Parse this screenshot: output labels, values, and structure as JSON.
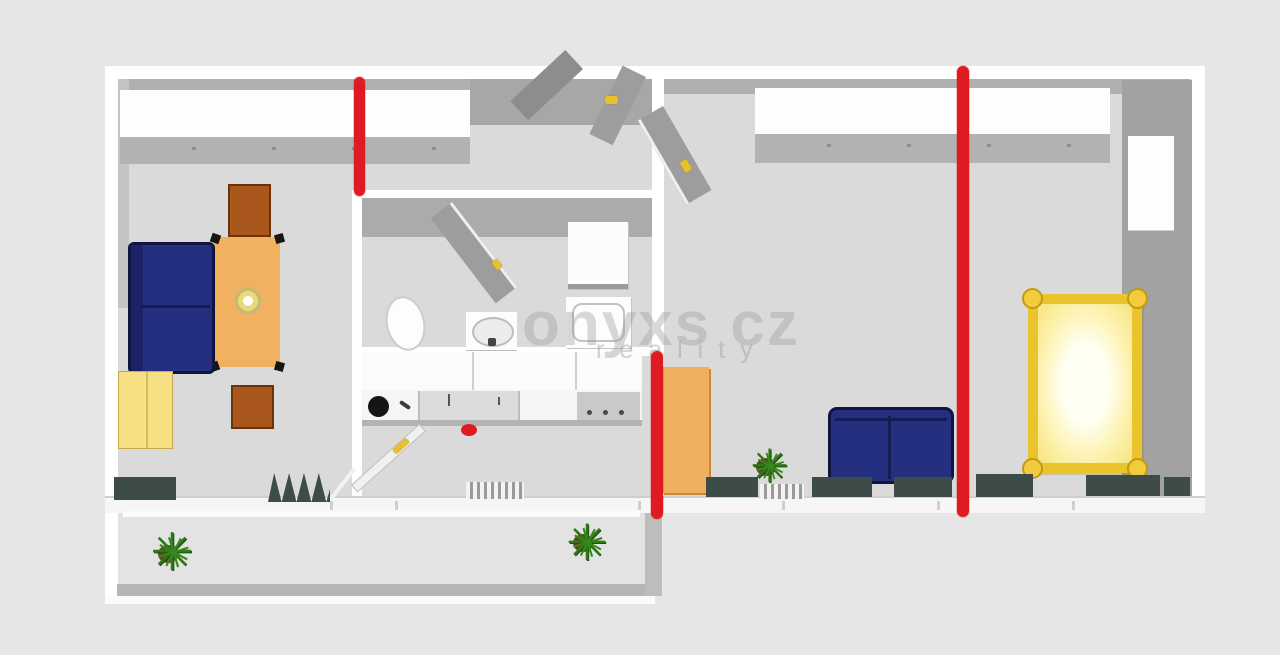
{
  "meta": {
    "type": "3d-floorplan-top-view",
    "description": "Apartment floor plan render with red reconstruction annotation marks"
  },
  "watermark": {
    "line1": "onyxs cz",
    "line2": "reality"
  },
  "annotations": {
    "red_line_count": 3,
    "red_dot_count": 1,
    "color": "#de1a22"
  },
  "colors": {
    "background": "#e6e6e6",
    "floor": "#dadada",
    "wall_white": "#ffffff",
    "wall_gray": "#ababab",
    "annotation_red": "#de1a22",
    "sofa_navy": "#252f80",
    "wood_orange": "#f0b060",
    "chair_brown": "#a9571c",
    "cabinet_yellow": "#f7e083",
    "bed_gold": "#e9c42c",
    "plant_green": "#2e7a17",
    "radiator_slate": "#3d4b49"
  },
  "rooms": {
    "left_room": [
      "wardrobe",
      "side-table",
      "dining-table",
      "sofa",
      "yellow-cabinet",
      "chair",
      "radiator",
      "drying-rack"
    ],
    "bathroom": [
      "door",
      "water-heater",
      "toilet",
      "washbasin",
      "shower-tray"
    ],
    "kitchen": [
      "upper-cabinets",
      "counter",
      "sink",
      "hob",
      "cooktop",
      "stove",
      "door",
      "radiator"
    ],
    "hall": [
      "entrance-door"
    ],
    "right_room": [
      "door",
      "wardrobe",
      "built-in-cupboard",
      "cabinet",
      "plant",
      "sofa",
      "bed",
      "radiators"
    ],
    "balcony": [
      "plant",
      "plant"
    ]
  }
}
